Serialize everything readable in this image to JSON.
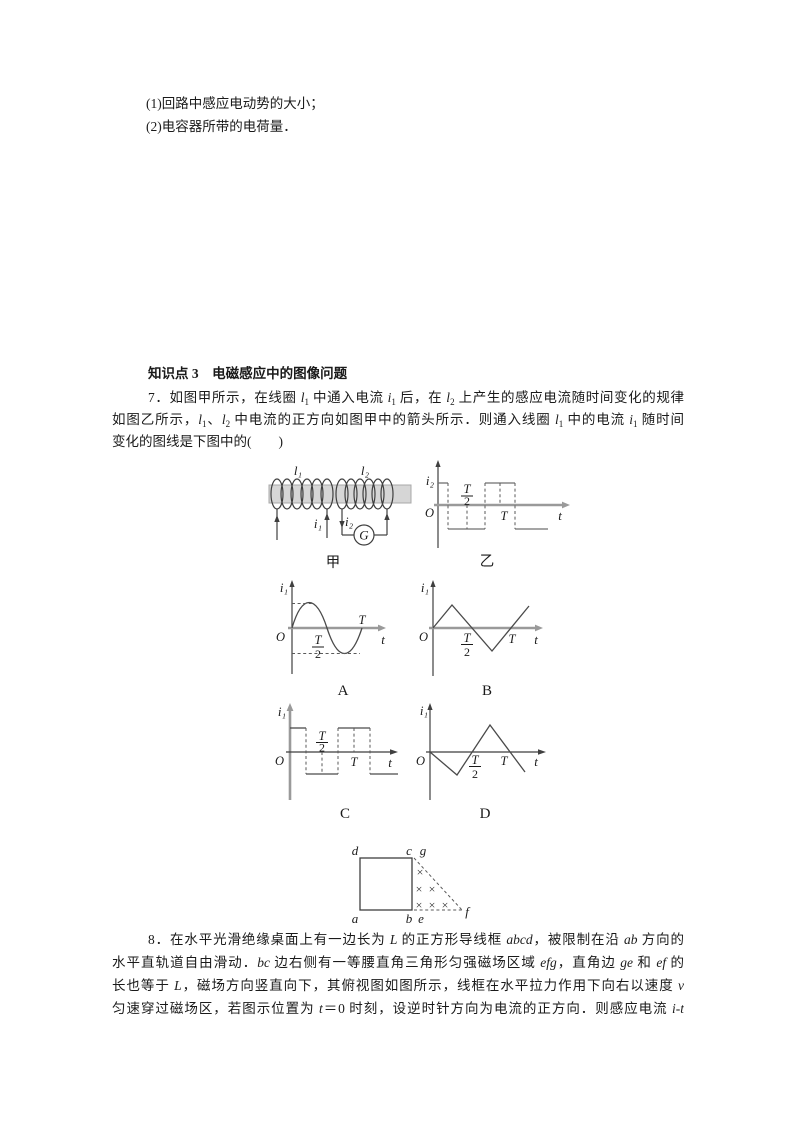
{
  "intro": {
    "line1": "(1)回路中感应电动势的大小；",
    "line2": "(2)电容器所带的电荷量．"
  },
  "section": {
    "heading": "知识点 3　电磁感应中的图像问题"
  },
  "q7": {
    "lines": [
      "7．如图甲所示，在线圈 <i>l</i><sub>1</sub> 中通入电流 <i>i</i><sub>1</sub> 后，在 <i>l</i><sub>2</sub> 上产生的感应电流随时间变化的规律",
      "如图乙所示，<i>l</i><sub>1</sub>、<i>l</i><sub>2</sub> 中电流的正方向如图甲中的箭头所示．则通入线圈 <i>l</i><sub>1</sub> 中的电流 <i>i</i><sub>1</sub> 随时间",
      "变化的图线是下图中的(　　)"
    ]
  },
  "q8": {
    "lines": [
      "8．在水平光滑绝缘桌面上有一边长为 <i>L</i> 的正方形导线框 <i>abcd</i>，被限制在沿 <i>ab</i> 方向的",
      "水平直轨道自由滑动．<i>bc</i> 边右侧有一等腰直角三角形匀强磁场区域 <i>efg</i>，直角边 <i>ge</i> 和 <i>ef</i> 的",
      "长也等于 <i>L</i>，磁场方向竖直向下，其俯视图如图所示，线框在水平拉力作用下向右以速度 <i>v</i>",
      "匀速穿过磁场区，若图示位置为 <i>t</i>＝0 时刻，设逆时针方向为电流的正方向．则感应电流 <i>i</i>-<i>t</i>"
    ]
  },
  "figures": {
    "jia": {
      "caption": "甲",
      "coil1_label": "l₁",
      "coil2_label": "l₂",
      "current1_label": "i₁",
      "current2_label": "i₂",
      "meter_label": "G"
    },
    "yi": {
      "caption": "乙",
      "y_axis": "i₂",
      "origin": "O",
      "frac_num": "T",
      "frac_den": "2",
      "period": "T",
      "x_axis": "t",
      "wave": {
        "type": "square",
        "positive_intervals_T": [
          [
            0,
            0.25
          ],
          [
            0.75,
            1.25
          ]
        ],
        "negative_intervals_T": [
          [
            0.25,
            0.75
          ],
          [
            1.25,
            1.8
          ]
        ]
      }
    },
    "optionA": {
      "label": "A",
      "y_axis": "i₁",
      "origin": "O",
      "frac_num": "T",
      "frac_den": "2",
      "period": "T",
      "x_axis": "t",
      "wave": {
        "type": "sine",
        "description": "positive half-cycle then negative half-cycle over one period T"
      }
    },
    "optionB": {
      "label": "B",
      "y_axis": "i₁",
      "origin": "O",
      "frac_num": "T",
      "frac_den": "2",
      "period": "T",
      "x_axis": "t",
      "wave": {
        "type": "triangle",
        "description": "rises from 0 to peak at T/4, falls to trough at 3T/4, rises past T"
      }
    },
    "optionC": {
      "label": "C",
      "y_axis": "i₁",
      "origin": "O",
      "frac_num": "T",
      "frac_den": "2",
      "period": "T",
      "x_axis": "t",
      "wave": {
        "type": "square",
        "positive_intervals_T": [
          [
            0,
            0.25
          ],
          [
            0.75,
            1.25
          ]
        ],
        "negative_intervals_T": [
          [
            0.25,
            0.75
          ],
          [
            1.25,
            1.7
          ]
        ]
      }
    },
    "optionD": {
      "label": "D",
      "y_axis": "i₁",
      "origin": "O",
      "frac_num": "T",
      "frac_den": "2",
      "period": "T",
      "x_axis": "t",
      "wave": {
        "type": "triangle-inverted",
        "description": "falls from 0 to trough at T/4, rises to peak at 3T/4, falls past T"
      }
    },
    "field": {
      "a": "a",
      "b": "b",
      "c": "c",
      "d": "d",
      "e": "e",
      "f": "f",
      "g": "g",
      "cross": "×",
      "description": "square wire frame abcd beside isosceles right-triangle field region efg with field into the page"
    }
  }
}
